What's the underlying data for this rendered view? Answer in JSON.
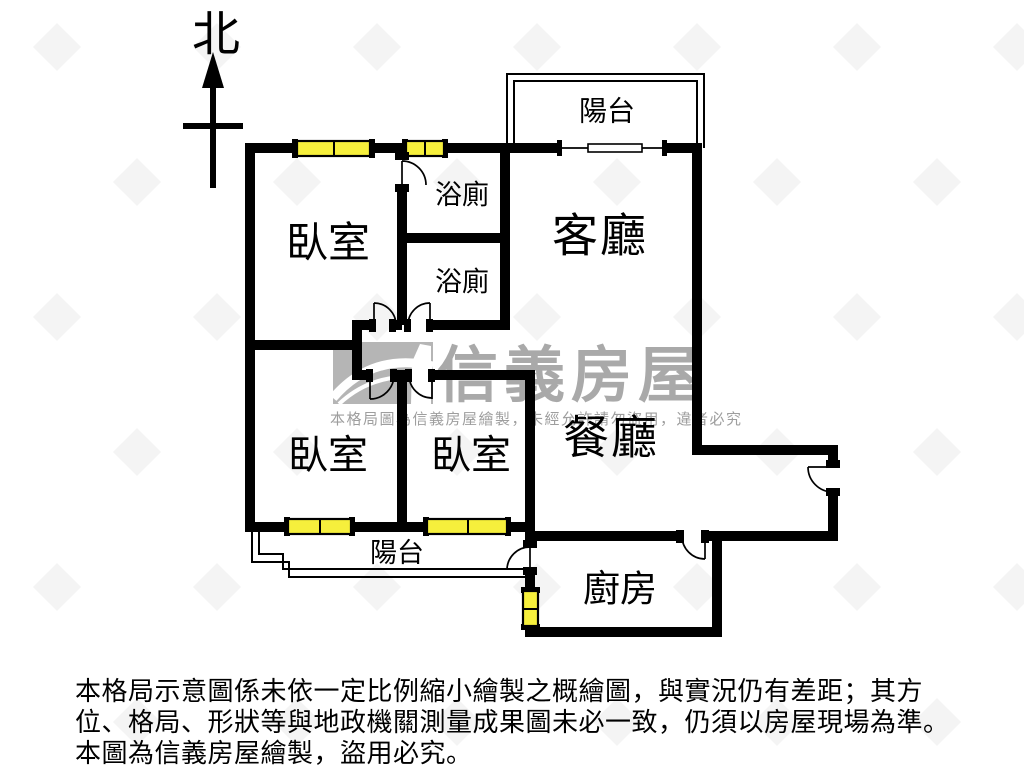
{
  "compass": {
    "north": "北"
  },
  "rooms": {
    "balcony_top": "陽台",
    "bath1": "浴廁",
    "bath2": "浴廁",
    "living": "客廳",
    "bedroom_main": "臥室",
    "bedroom_left": "臥室",
    "bedroom_mid": "臥室",
    "dining": "餐廳",
    "balcony_bottom": "陽台",
    "kitchen": "廚房"
  },
  "watermark": {
    "brand": "信義房屋",
    "notice": "本格局圖為信義房屋繪製，未經允許請勿盜用，違者必究"
  },
  "disclaimer": {
    "line1": "本格局示意圖係未依一定比例縮小繪製之概繪圖，與實況仍有差距；其方",
    "line2": "位、格局、形狀等與地政機關測量成果圖未必一致，仍須以房屋現場為準。",
    "line3": "本圖為信義房屋繪製，盜用必究。"
  },
  "colors": {
    "wall": "#000000",
    "window": "#f6ef3c",
    "watermark_gray": "#a9a9a9",
    "logo_gray": "#b5b5b5"
  }
}
